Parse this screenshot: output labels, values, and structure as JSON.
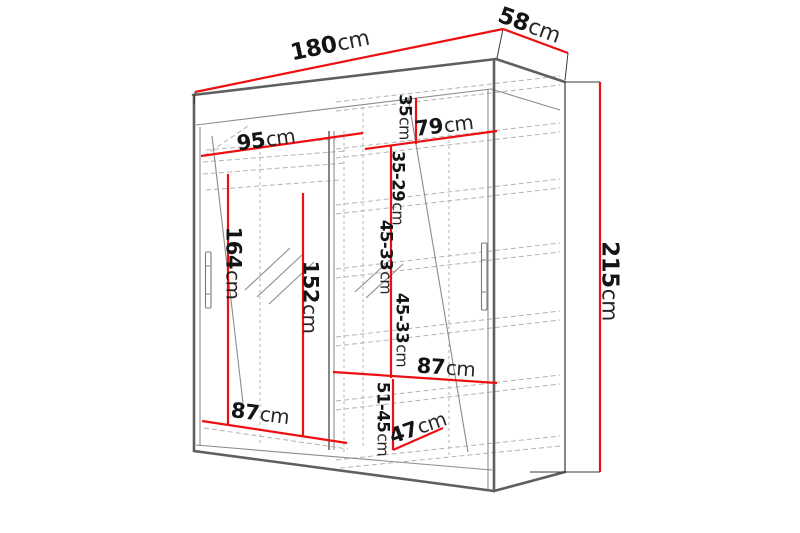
{
  "diagram_title": "wardrobe-dimension-diagram",
  "colors": {
    "dimension_line": "#ec1012",
    "outline": "#5f5f5f",
    "thin_line": "#8c8c8c",
    "dashed_line": "#b3b3b3",
    "label_text": "#141414",
    "background": "#ffffff"
  },
  "dims": {
    "width": {
      "value": "180",
      "unit": "cm"
    },
    "depth": {
      "value": "58",
      "unit": "cm"
    },
    "height": {
      "value": "215",
      "unit": "cm"
    },
    "left_top_width": {
      "value": "95",
      "unit": "cm"
    },
    "right_top_width": {
      "value": "79",
      "unit": "cm"
    },
    "top_shelf_gap": {
      "value": "35",
      "unit": "cm"
    },
    "shelf_gap_35_29": {
      "value": "35-29",
      "unit": "cm"
    },
    "shelf_gap_45_33_upper": {
      "value": "45-33",
      "unit": "cm"
    },
    "shelf_gap_45_33_lower": {
      "value": "45-33",
      "unit": "cm"
    },
    "left_hanging_height": {
      "value": "164",
      "unit": "cm"
    },
    "left_inner_height": {
      "value": "152",
      "unit": "cm"
    },
    "bottom_left_width": {
      "value": "87",
      "unit": "cm"
    },
    "right_shelf_width": {
      "value": "87",
      "unit": "cm"
    },
    "bottom_shelf_gap": {
      "value": "51-45",
      "unit": "cm"
    },
    "bottom_inner_depth": {
      "value": "47",
      "unit": "cm"
    }
  }
}
